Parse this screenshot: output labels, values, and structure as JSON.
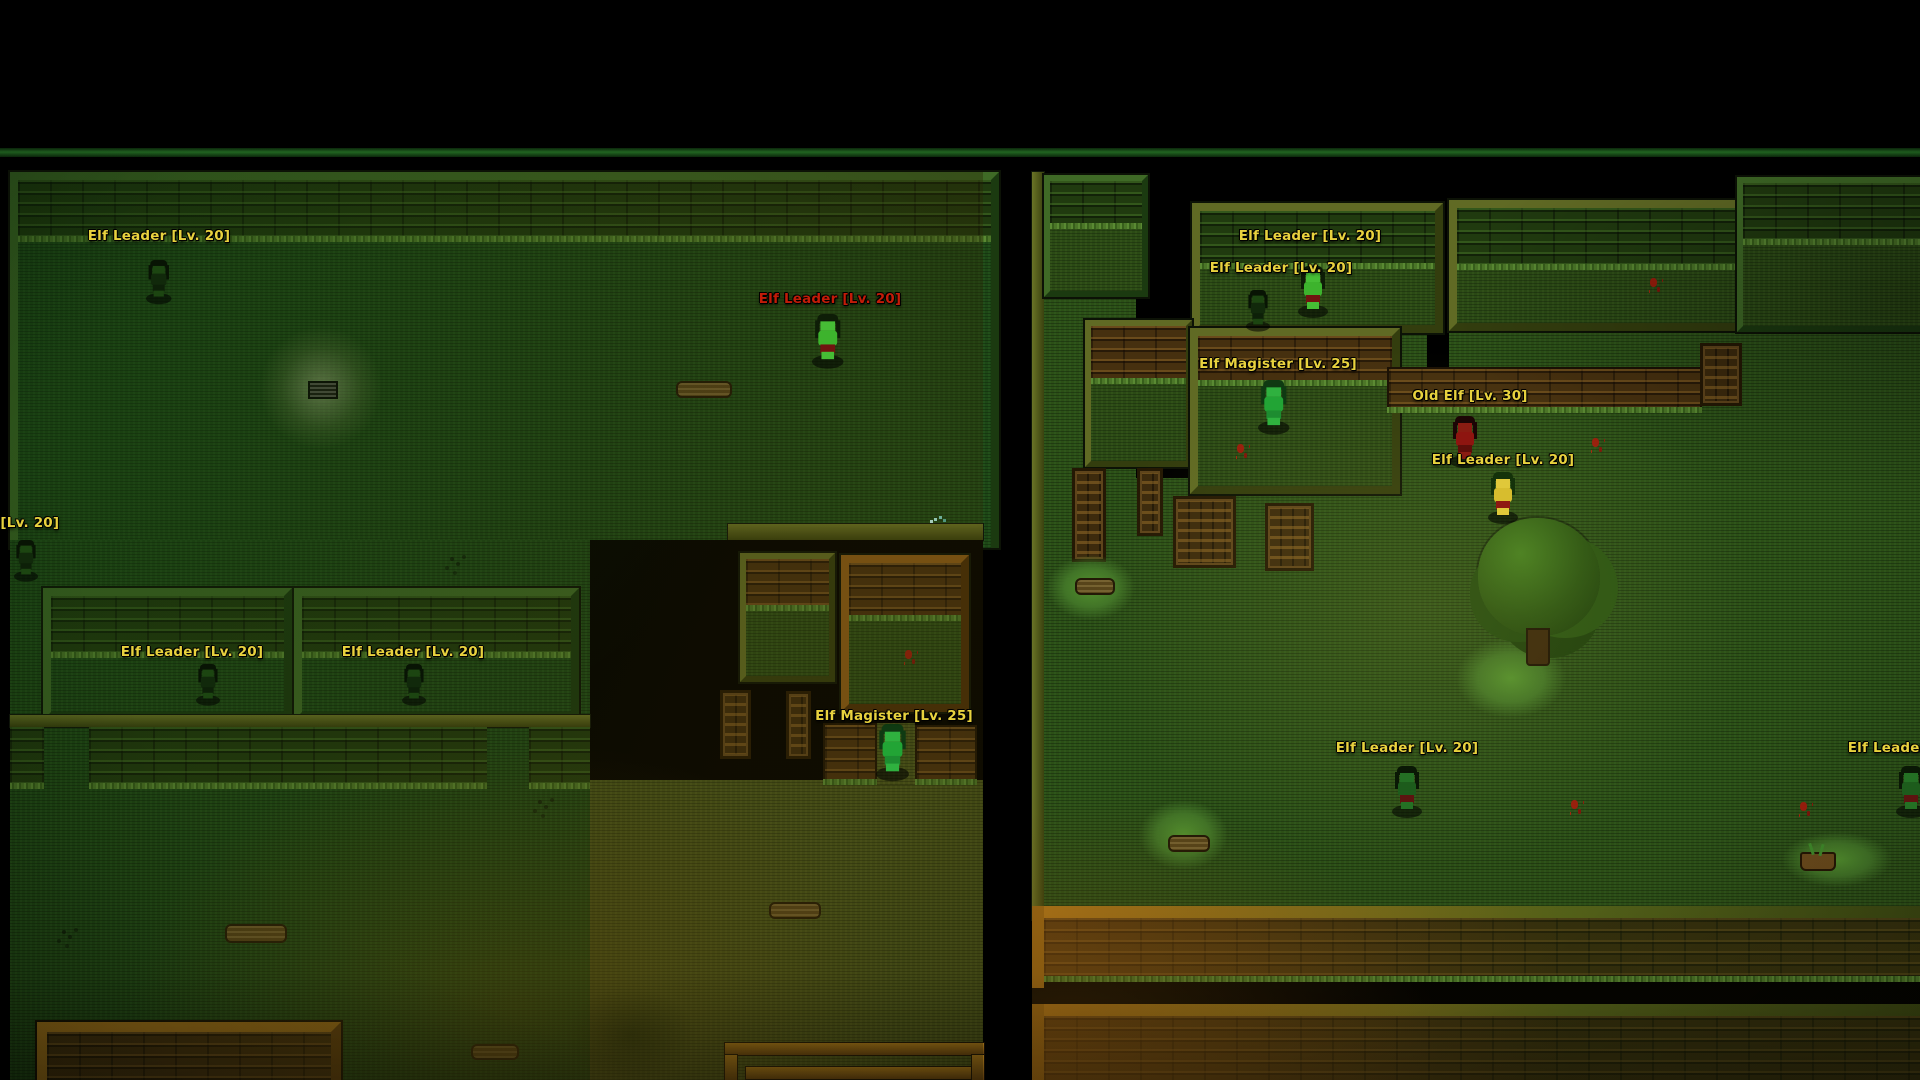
{
  "palette": {
    "label_yellow": "#e8d23e",
    "label_red": "#c21c08",
    "grass_green": "#1d4716",
    "grass_olive": "#44511a",
    "wood_brown": "#46300f",
    "wood_green": "#203a0f",
    "frame_olive": "#606a24",
    "frame_green": "#3f6a26",
    "frame_orange": "#b9821c",
    "blood_red": "#9a1d0c",
    "glow_light": "#c8d2a0",
    "sparkle_cyan": "#aef5ea",
    "top_line_green": "#1e641e"
  },
  "sprite_variants": {
    "bright-green": {
      "hair": "#0e1d07",
      "torso": "#3db32d",
      "skin": "#46bd35",
      "outfit": "#701410"
    },
    "magister": {
      "hair": "#0f3a12",
      "torso": "#22a435",
      "skin": "#2fb13f",
      "outfit": "#1d8c30"
    },
    "dark-green": {
      "hair": "#0a1805",
      "torso": "#1d5c1c",
      "skin": "#247024",
      "outfit": "#5c1410"
    },
    "shadow": {
      "hair": "#081404",
      "torso": "#11290b",
      "skin": "#1c4511",
      "outfit": "#0d2008"
    },
    "red-robe": {
      "hair": "#1c0505",
      "torso": "#8e1510",
      "skin": "#8a1c12",
      "outfit": "#5e0e0a"
    },
    "yellow": {
      "hair": "#14320a",
      "torso": "#d7bd2e",
      "skin": "#e0c83a",
      "outfit": "#8e1812"
    }
  },
  "entities": [
    {
      "id": "elf-leader-hall-nw",
      "label": "Elf Leader [Lv. 20]",
      "label_color": "label_yellow",
      "label_x": 159,
      "label_y": 228,
      "sprite": {
        "variant": "shadow",
        "x": 146,
        "y": 260,
        "scale": 0.85
      }
    },
    {
      "id": "elf-leader-hall-red",
      "label": "Elf Leader [Lv. 20]",
      "label_color": "label_red",
      "label_x": 830,
      "label_y": 291,
      "sprite": {
        "variant": "bright-green",
        "x": 812,
        "y": 314,
        "scale": 1.05
      }
    },
    {
      "id": "elf-leader-left-edge",
      "label": "Elf Leader [Lv. 20]",
      "label_color": "label_yellow",
      "label_x": -12,
      "label_y": 515,
      "sprite": {
        "variant": "shadow",
        "x": 14,
        "y": 540,
        "scale": 0.8
      }
    },
    {
      "id": "elf-leader-house-1",
      "label": "Elf Leader [Lv. 20]",
      "label_color": "label_yellow",
      "label_x": 192,
      "label_y": 644,
      "sprite": {
        "variant": "shadow",
        "x": 196,
        "y": 664,
        "scale": 0.8
      }
    },
    {
      "id": "elf-leader-house-2",
      "label": "Elf Leader [Lv. 20]",
      "label_color": "label_yellow",
      "label_x": 413,
      "label_y": 644,
      "sprite": {
        "variant": "shadow",
        "x": 402,
        "y": 664,
        "scale": 0.8
      }
    },
    {
      "id": "elf-magister-south",
      "label": "Elf Magister [Lv. 25]",
      "label_color": "label_yellow",
      "label_x": 894,
      "label_y": 708,
      "sprite": {
        "variant": "magister",
        "x": 876,
        "y": 724,
        "scale": 1.1
      }
    },
    {
      "id": "elf-leader-village-a",
      "label": "Elf Leader [Lv. 20]",
      "label_color": "label_yellow",
      "label_x": 1310,
      "label_y": 228,
      "sprite": {
        "variant": "bright-green",
        "x": 1298,
        "y": 266,
        "scale": 1.0
      }
    },
    {
      "id": "elf-leader-village-b",
      "label": "Elf Leader [Lv. 20]",
      "label_color": "label_yellow",
      "label_x": 1281,
      "label_y": 260,
      "sprite": {
        "variant": "shadow",
        "x": 1246,
        "y": 290,
        "scale": 0.8
      }
    },
    {
      "id": "elf-magister-village",
      "label": "Elf Magister [Lv. 25]",
      "label_color": "label_yellow",
      "label_x": 1278,
      "label_y": 356,
      "sprite": {
        "variant": "magister",
        "x": 1258,
        "y": 380,
        "scale": 1.05
      }
    },
    {
      "id": "old-elf",
      "label": "Old Elf [Lv. 30]",
      "label_color": "label_yellow",
      "label_x": 1470,
      "label_y": 388,
      "sprite": {
        "variant": "red-robe",
        "x": 1450,
        "y": 416,
        "scale": 1.0
      }
    },
    {
      "id": "elf-leader-yellow",
      "label": "Elf Leader [Lv. 20]",
      "label_color": "label_yellow",
      "label_x": 1503,
      "label_y": 452,
      "sprite": {
        "variant": "yellow",
        "x": 1488,
        "y": 472,
        "scale": 1.0
      }
    },
    {
      "id": "elf-leader-south",
      "label": "Elf Leader [Lv. 20]",
      "label_color": "label_yellow",
      "label_x": 1407,
      "label_y": 740,
      "sprite": {
        "variant": "dark-green",
        "x": 1392,
        "y": 766,
        "scale": 1.0
      }
    },
    {
      "id": "elf-leader-right-edge",
      "label": "Elf Leader [Lv. 20]",
      "label_color": "label_yellow",
      "label_x": 1919,
      "label_y": 740,
      "sprite": {
        "variant": "dark-green",
        "x": 1896,
        "y": 766,
        "scale": 1.0
      }
    }
  ]
}
